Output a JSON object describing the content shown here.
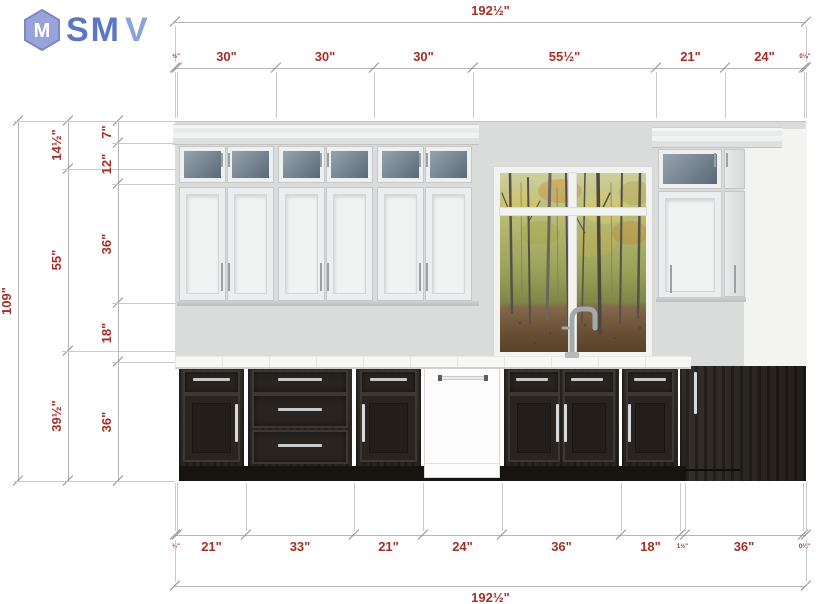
{
  "logo": {
    "brand_sm": "SM",
    "brand_v": "V",
    "icon_letter": "M"
  },
  "palette": {
    "dim_text": "#a33028",
    "dim_line": "#b7b7b7",
    "tick": "#8f8f8f",
    "ext_line": "#cacaca",
    "wall": "#dadbdb",
    "cab_white": "#ecedee",
    "cab_border": "#c6c7c8",
    "glass_dark": "#5a6976",
    "glass_light": "#97a3af",
    "counter": "#f7f7f6",
    "dark_cab": "#2d2824",
    "toe_kick": "#17130f",
    "handle_silver": "#c6c9ca",
    "logo_blue": "#5b76c4",
    "logo_light": "#8ba3d8",
    "window_frame": "#f2f2f1"
  },
  "dimension_rows": [
    {
      "name": "top-overall",
      "type": "h",
      "y": 22,
      "bounds": [
        175,
        806
      ],
      "labels": [
        "192½\""
      ],
      "ext": [
        26,
        62
      ],
      "side": "above"
    },
    {
      "name": "top-segments",
      "type": "h",
      "y": 68,
      "bounds": [
        175,
        177,
        276,
        374,
        473,
        656,
        725,
        804,
        806
      ],
      "labels": [
        "½\"",
        "30\"",
        "30\"",
        "30\"",
        "55½\"",
        "21\"",
        "24\"",
        "0¼\""
      ],
      "ext": [
        72,
        118
      ],
      "side": "above"
    },
    {
      "name": "left-overall",
      "type": "v",
      "x": 18,
      "bounds": [
        121,
        481
      ],
      "labels": [
        "109\""
      ],
      "ext": [
        14,
        175
      ]
    },
    {
      "name": "left-mid",
      "type": "v",
      "x": 68,
      "bounds": [
        121,
        169,
        351,
        481
      ],
      "labels": [
        "14½\"",
        "55\"",
        "39½\""
      ],
      "ext": [
        62,
        175
      ]
    },
    {
      "name": "left-inner",
      "type": "v",
      "x": 118,
      "bounds": [
        121,
        143,
        184,
        303,
        362,
        481
      ],
      "labels": [
        "7\"",
        "12\"",
        "36\"",
        "18\"",
        "36\""
      ],
      "ext": [
        112,
        175
      ]
    },
    {
      "name": "bottom-segments",
      "type": "h",
      "y": 535,
      "bounds": [
        175,
        177,
        246,
        354,
        423,
        502,
        621,
        680,
        685,
        803,
        806
      ],
      "labels": [
        "½\"",
        "21\"",
        "33\"",
        "21\"",
        "24\"",
        "36\"",
        "18\"",
        "1½\"",
        "36\"",
        "0¼\""
      ],
      "ext": [
        483,
        531
      ],
      "side": "below"
    },
    {
      "name": "bottom-overall",
      "type": "h",
      "y": 586,
      "bounds": [
        175,
        806
      ],
      "labels": [
        "192½\""
      ],
      "ext": [
        540,
        582
      ],
      "side": "below"
    }
  ]
}
